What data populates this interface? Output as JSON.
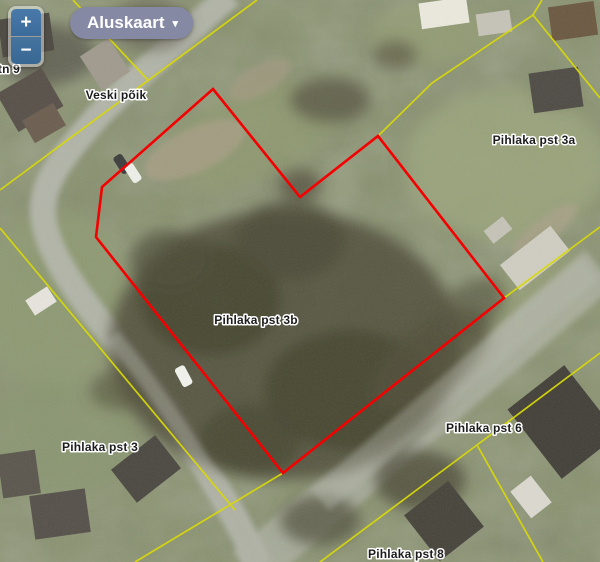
{
  "window": {
    "width": 600,
    "height": 562
  },
  "controls": {
    "zoom_in_label": "+",
    "zoom_out_label": "−",
    "basemap": {
      "label": "Aluskaart",
      "caret": "▾"
    }
  },
  "map": {
    "type": "orthophoto-with-cadastral-boundaries",
    "selected_parcel": "Pihlaka pst 3b",
    "colors": {
      "parcel_boundary": "#d8d808",
      "selected_outline": "#f40000",
      "zoom_button": "#3e6d9c",
      "basemap_button": "#8589a4"
    },
    "labels": [
      {
        "text": "ki tn 9"
      },
      {
        "text": "Veski põik"
      },
      {
        "text": "Pihlaka pst 3a"
      },
      {
        "text": "Pihlaka pst 3b"
      },
      {
        "text": "Pihlaka pst 3"
      },
      {
        "text": "Pihlaka pst 6"
      },
      {
        "text": "Pihlaka pst 8"
      }
    ]
  }
}
